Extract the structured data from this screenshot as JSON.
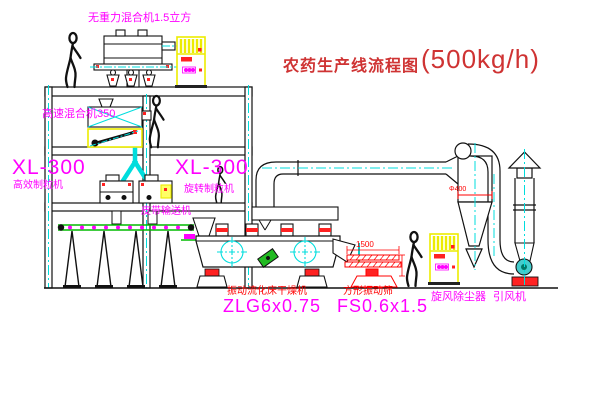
{
  "title": {
    "text": "农药生产线流程图",
    "capacity": "(500kg/h)"
  },
  "labels": {
    "gravity_mixer": "无重力混合机1.5立方",
    "high_speed_mixer": "高速混合机350",
    "granulator_left": {
      "model": "XL-300",
      "name": "高效制粒机"
    },
    "granulator_center": {
      "model": "XL-300",
      "name": "旋转制粒机"
    },
    "belt_conveyor": "皮带输送机",
    "dryer": {
      "name": "振动流化床干燥机",
      "model": "ZLG6x0.75"
    },
    "sieve": {
      "name": "方形振动筛",
      "model": "FS0.6x1.5"
    },
    "cyclone": "旋风除尘器",
    "fan": "引风机"
  },
  "dimensions": {
    "sieve_length": "1500",
    "cyclone_diameter": "Φ400"
  },
  "colors": {
    "background": "#ffffff",
    "line_black": "#111111",
    "title_red": "#cf3333",
    "label_red": "#ff0000",
    "label_magenta": "#ff00ff",
    "centerline_cyan": "#00dddd",
    "cabinet_yellow": "#ecec00",
    "conveyor_green": "#00bb00",
    "motor_green": "#22bb22"
  }
}
